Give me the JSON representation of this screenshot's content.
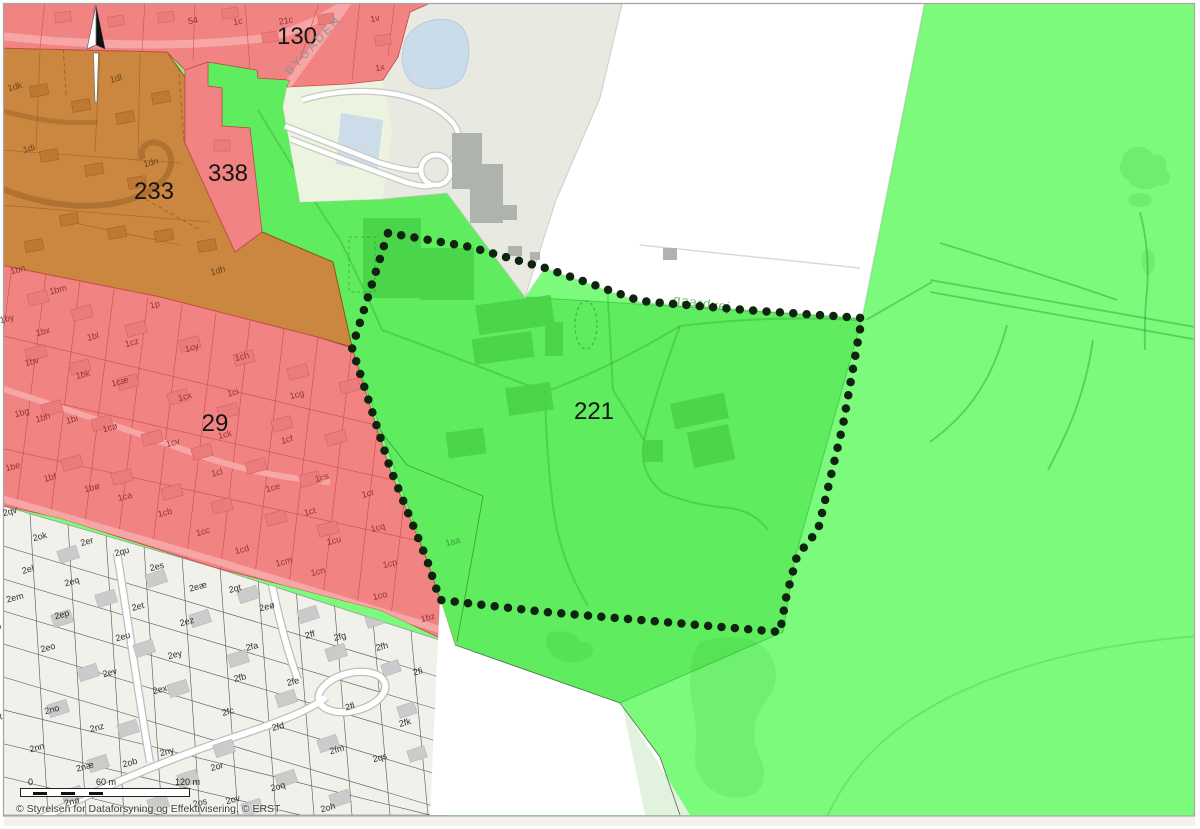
{
  "map": {
    "copyright": "© Styrelsen for Dataforsyning og Effektivisering, © ERST",
    "scalebar": {
      "zero": "0",
      "mid": "60 m",
      "end": "120 m"
    },
    "icons": [
      {
        "name": "north-arrow"
      }
    ],
    "colors": {
      "zone_green_light": "#7BFA7B",
      "zone_green": "#5FEC5F",
      "zone_red": "#F28383",
      "zone_orange": "#CB8640",
      "zone_grey": "#E8EAE2",
      "cadastral_bg": "#F1F1EB",
      "water": "#CADCEA",
      "boundary_dots": "#0F240F"
    },
    "labels": [
      {
        "t": "130",
        "x": 297,
        "y": 37,
        "k": "big"
      },
      {
        "t": "338",
        "x": 228,
        "y": 174,
        "k": "big"
      },
      {
        "t": "233",
        "x": 154,
        "y": 192,
        "k": "big"
      },
      {
        "t": "29",
        "x": 215,
        "y": 424,
        "k": "big"
      },
      {
        "t": "221",
        "x": 594,
        "y": 412,
        "k": "big"
      },
      {
        "t": "BYGADEN",
        "x": 313,
        "y": 45,
        "k": "bygaden",
        "r": -47
      },
      {
        "t": "gaardvej",
        "x": 702,
        "y": 303,
        "k": "greenstreet",
        "r": 8
      },
      {
        "t": "7000q",
        "x": 63,
        "y": 36,
        "k": "roadred",
        "r": -5
      },
      {
        "t": "7000c",
        "x": -12,
        "y": 661,
        "k": "roadgrey",
        "r": -15
      },
      {
        "t": "54",
        "x": 193,
        "y": 21,
        "k": "red",
        "r": -10
      },
      {
        "t": "1c",
        "x": 238,
        "y": 22,
        "k": "red",
        "r": -10
      },
      {
        "t": "21c",
        "x": 286,
        "y": 21,
        "k": "red",
        "r": -10
      },
      {
        "t": "1v",
        "x": 375,
        "y": 19,
        "k": "red",
        "r": -10
      },
      {
        "t": "1x",
        "x": 380,
        "y": 68,
        "k": "red",
        "r": -10
      },
      {
        "t": "1dk",
        "x": 15,
        "y": 87,
        "k": "orange"
      },
      {
        "t": "1dl",
        "x": 116,
        "y": 79,
        "k": "orange"
      },
      {
        "t": "1di",
        "x": 29,
        "y": 149,
        "k": "orange"
      },
      {
        "t": "1dn",
        "x": 151,
        "y": 163,
        "k": "orange"
      },
      {
        "t": "1dh",
        "x": 218,
        "y": 271,
        "k": "orange"
      },
      {
        "t": "1bn",
        "x": 18,
        "y": 270,
        "k": "red"
      },
      {
        "t": "1bm",
        "x": 58,
        "y": 290,
        "k": "red"
      },
      {
        "t": "1p",
        "x": 155,
        "y": 305,
        "k": "red"
      },
      {
        "t": "1by",
        "x": 7,
        "y": 319,
        "k": "red"
      },
      {
        "t": "1bx",
        "x": 43,
        "y": 332,
        "k": "red"
      },
      {
        "t": "1bl",
        "x": 93,
        "y": 337,
        "k": "red"
      },
      {
        "t": "1cz",
        "x": 132,
        "y": 343,
        "k": "red"
      },
      {
        "t": "1cy",
        "x": 192,
        "y": 348,
        "k": "red"
      },
      {
        "t": "1ch",
        "x": 242,
        "y": 357,
        "k": "red"
      },
      {
        "t": "1bv",
        "x": 32,
        "y": 362,
        "k": "red"
      },
      {
        "t": "1bk",
        "x": 83,
        "y": 375,
        "k": "red"
      },
      {
        "t": "1cæ",
        "x": 120,
        "y": 382,
        "k": "red"
      },
      {
        "t": "1cx",
        "x": 185,
        "y": 397,
        "k": "red"
      },
      {
        "t": "1ci",
        "x": 233,
        "y": 393,
        "k": "red"
      },
      {
        "t": "1cg",
        "x": 297,
        "y": 395,
        "k": "red"
      },
      {
        "t": "1bg",
        "x": 22,
        "y": 413,
        "k": "red"
      },
      {
        "t": "1bh",
        "x": 43,
        "y": 418,
        "k": "red"
      },
      {
        "t": "1bi",
        "x": 72,
        "y": 420,
        "k": "red"
      },
      {
        "t": "1cø",
        "x": 110,
        "y": 428,
        "k": "red"
      },
      {
        "t": "1cv",
        "x": 173,
        "y": 443,
        "k": "red"
      },
      {
        "t": "1ck",
        "x": 225,
        "y": 435,
        "k": "red"
      },
      {
        "t": "1cf",
        "x": 287,
        "y": 440,
        "k": "red"
      },
      {
        "t": "1be",
        "x": 13,
        "y": 467,
        "k": "red"
      },
      {
        "t": "1bf",
        "x": 50,
        "y": 478,
        "k": "red"
      },
      {
        "t": "1bø",
        "x": 92,
        "y": 488,
        "k": "red"
      },
      {
        "t": "1ca",
        "x": 125,
        "y": 497,
        "k": "red"
      },
      {
        "t": "1cl",
        "x": 217,
        "y": 473,
        "k": "red"
      },
      {
        "t": "1ce",
        "x": 273,
        "y": 488,
        "k": "red"
      },
      {
        "t": "1cs",
        "x": 322,
        "y": 478,
        "k": "red"
      },
      {
        "t": "1cr",
        "x": 368,
        "y": 494,
        "k": "red"
      },
      {
        "t": "1cb",
        "x": 165,
        "y": 513,
        "k": "red"
      },
      {
        "t": "1ct",
        "x": 310,
        "y": 512,
        "k": "red"
      },
      {
        "t": "1cc",
        "x": 203,
        "y": 532,
        "k": "red"
      },
      {
        "t": "1cq",
        "x": 378,
        "y": 528,
        "k": "red"
      },
      {
        "t": "1cu",
        "x": 334,
        "y": 541,
        "k": "red"
      },
      {
        "t": "1cd",
        "x": 242,
        "y": 550,
        "k": "red"
      },
      {
        "t": "1cm",
        "x": 284,
        "y": 562,
        "k": "red"
      },
      {
        "t": "1cn",
        "x": 318,
        "y": 572,
        "k": "red"
      },
      {
        "t": "1cp",
        "x": 390,
        "y": 564,
        "k": "red"
      },
      {
        "t": "1co",
        "x": 380,
        "y": 596,
        "k": "red"
      },
      {
        "t": "1bz",
        "x": 428,
        "y": 618,
        "k": "red"
      },
      {
        "t": "1aa",
        "x": 453,
        "y": 542,
        "k": "green"
      },
      {
        "t": "2qv",
        "x": 10,
        "y": 512,
        "k": "white"
      },
      {
        "t": "2ok",
        "x": 40,
        "y": 537,
        "k": "white"
      },
      {
        "t": "2er",
        "x": 87,
        "y": 542,
        "k": "white"
      },
      {
        "t": "2qu",
        "x": 122,
        "y": 552,
        "k": "white"
      },
      {
        "t": "2es",
        "x": 157,
        "y": 567,
        "k": "white"
      },
      {
        "t": "2el",
        "x": 28,
        "y": 570,
        "k": "white"
      },
      {
        "t": "2eq",
        "x": 72,
        "y": 582,
        "k": "white"
      },
      {
        "t": "2eæ",
        "x": 198,
        "y": 587,
        "k": "white"
      },
      {
        "t": "2qt",
        "x": 235,
        "y": 589,
        "k": "white"
      },
      {
        "t": "2em",
        "x": 15,
        "y": 598,
        "k": "white"
      },
      {
        "t": "2et",
        "x": 138,
        "y": 607,
        "k": "white"
      },
      {
        "t": "2eø",
        "x": 267,
        "y": 607,
        "k": "white"
      },
      {
        "t": "2ep",
        "x": 62,
        "y": 615,
        "k": "white"
      },
      {
        "t": "2ez",
        "x": 187,
        "y": 622,
        "k": "white"
      },
      {
        "t": "2en",
        "x": -6,
        "y": 628,
        "k": "white"
      },
      {
        "t": "2eu",
        "x": 123,
        "y": 637,
        "k": "white"
      },
      {
        "t": "2ff",
        "x": 310,
        "y": 635,
        "k": "white"
      },
      {
        "t": "2fg",
        "x": 340,
        "y": 637,
        "k": "white"
      },
      {
        "t": "2fh",
        "x": 382,
        "y": 647,
        "k": "white"
      },
      {
        "t": "2eo",
        "x": 48,
        "y": 648,
        "k": "white"
      },
      {
        "t": "2ey",
        "x": 175,
        "y": 655,
        "k": "white"
      },
      {
        "t": "2fa",
        "x": 252,
        "y": 647,
        "k": "white"
      },
      {
        "t": "2ev",
        "x": 110,
        "y": 673,
        "k": "white"
      },
      {
        "t": "2fb",
        "x": 240,
        "y": 678,
        "k": "white"
      },
      {
        "t": "2fe",
        "x": 293,
        "y": 682,
        "k": "white"
      },
      {
        "t": "2ex",
        "x": 160,
        "y": 690,
        "k": "white"
      },
      {
        "t": "2no",
        "x": 52,
        "y": 710,
        "k": "white"
      },
      {
        "t": "2fc",
        "x": 228,
        "y": 712,
        "k": "white"
      },
      {
        "t": "2fi",
        "x": 418,
        "y": 672,
        "k": "white"
      },
      {
        "t": "2fl",
        "x": 350,
        "y": 707,
        "k": "white"
      },
      {
        "t": "2fk",
        "x": 405,
        "y": 723,
        "k": "white"
      },
      {
        "t": "2nt",
        "x": -4,
        "y": 718,
        "k": "white"
      },
      {
        "t": "2nz",
        "x": 97,
        "y": 728,
        "k": "white"
      },
      {
        "t": "2fd",
        "x": 278,
        "y": 727,
        "k": "white"
      },
      {
        "t": "2nn",
        "x": 37,
        "y": 748,
        "k": "white"
      },
      {
        "t": "2ny",
        "x": 167,
        "y": 752,
        "k": "white"
      },
      {
        "t": "2fm",
        "x": 337,
        "y": 750,
        "k": "white"
      },
      {
        "t": "2qs",
        "x": 380,
        "y": 758,
        "k": "white"
      },
      {
        "t": "2næ",
        "x": 85,
        "y": 767,
        "k": "white"
      },
      {
        "t": "2ob",
        "x": 130,
        "y": 763,
        "k": "white"
      },
      {
        "t": "2or",
        "x": 217,
        "y": 767,
        "k": "white"
      },
      {
        "t": "2oq",
        "x": 278,
        "y": 787,
        "k": "white"
      },
      {
        "t": "2nø",
        "x": 72,
        "y": 802,
        "k": "white"
      },
      {
        "t": "2os",
        "x": 200,
        "y": 803,
        "k": "white"
      },
      {
        "t": "2ov",
        "x": 233,
        "y": 800,
        "k": "white"
      },
      {
        "t": "2oh",
        "x": 328,
        "y": 808,
        "k": "white"
      }
    ]
  }
}
